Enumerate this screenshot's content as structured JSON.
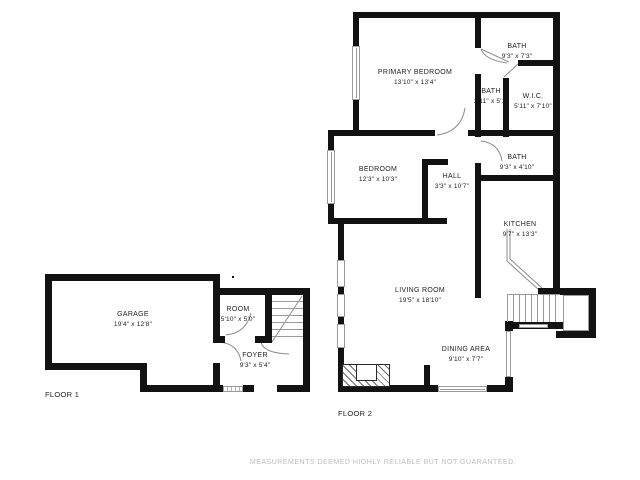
{
  "floor1": {
    "label": "FLOOR 1",
    "rooms": {
      "garage": {
        "name": "GARAGE",
        "dims": "19'4\" x 12'8\""
      },
      "room": {
        "name": "ROOM",
        "dims": "5'10\" x 5'0\""
      },
      "foyer": {
        "name": "FOYER",
        "dims": "9'3\" x 5'4\""
      }
    }
  },
  "floor2": {
    "label": "FLOOR 2",
    "rooms": {
      "primary_bedroom": {
        "name": "PRIMARY BEDROOM",
        "dims": "13'10\" x 13'4\""
      },
      "bath_top": {
        "name": "BATH",
        "dims": "9'3\" x 7'3\""
      },
      "bath_small": {
        "name": "BATH",
        "dims": "2'11\" x 5'1\""
      },
      "wic": {
        "name": "W.I.C.",
        "dims": "5'11\" x 7'10\""
      },
      "bath_mid": {
        "name": "BATH",
        "dims": "9'3\" x 4'10\""
      },
      "hall": {
        "name": "HALL",
        "dims": "3'3\" x 10'7\""
      },
      "bedroom": {
        "name": "BEDROOM",
        "dims": "12'3\" x 10'3\""
      },
      "kitchen": {
        "name": "KITCHEN",
        "dims": "9'7\" x 13'3\""
      },
      "living_room": {
        "name": "LIVING ROOM",
        "dims": "19'5\" x 18'10\""
      },
      "dining_area": {
        "name": "DINING AREA",
        "dims": "9'10\" x 7'7\""
      }
    }
  },
  "disclaimer": "MEASUREMENTS DEEMED HIGHLY RELIABLE BUT NOT GUARANTEED.",
  "colors": {
    "wall": "#121212",
    "window": "#9a9a9a",
    "text": "#1e1e1e",
    "disclaimer": "#bdbdbd"
  }
}
